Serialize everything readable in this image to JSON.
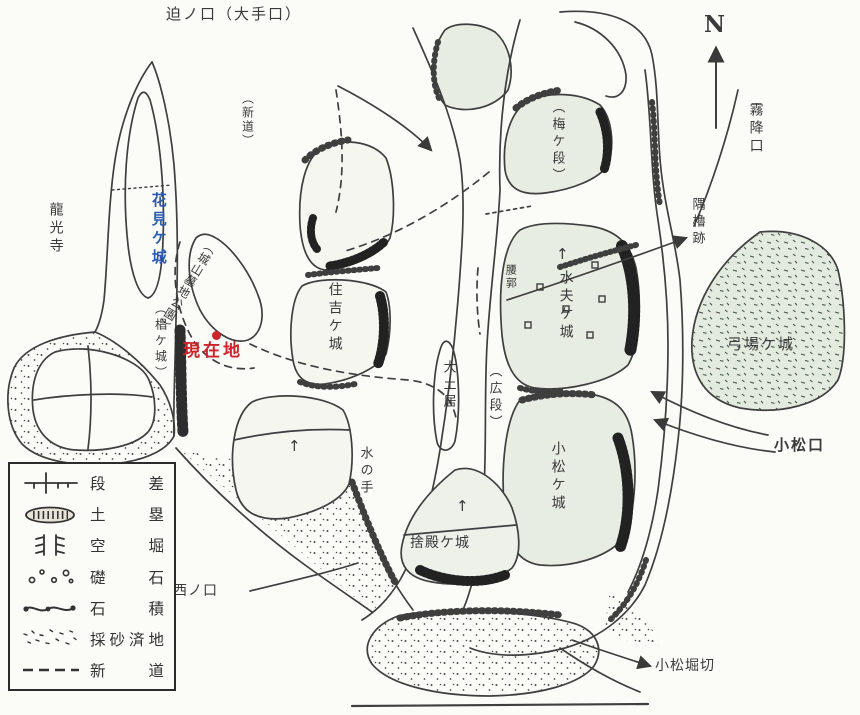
{
  "colors": {
    "paper": "#fbfbf8",
    "ink": "#3a3a3a",
    "plateau_green": "#e8ede3",
    "pale_plateau": "#f6f6f1",
    "accent_blue": "#2b5cad",
    "accent_red": "#c9252a"
  },
  "map": {
    "labels": {
      "sako_guchi": {
        "text": "迫ノ口（大手口）"
      },
      "shindo": {
        "text": "（新道）"
      },
      "north": {
        "text": "N"
      },
      "kirifuri_guchi": {
        "text": "霧降口"
      },
      "umegadan": {
        "text": "（梅ケ段）"
      },
      "sumiyagura_ato": {
        "text": "隅櫓跡"
      },
      "ryukoji": {
        "text": "龍光寺"
      },
      "hanamigajo": {
        "text": "花見ケ城"
      },
      "sugigajo": {
        "text": "（椙ケ城）"
      },
      "bochi_koen": {
        "text": "（城山墓地公園）"
      },
      "genzaichi": {
        "text": "現在地"
      },
      "sumiyoshigajo": {
        "text": "住吉ケ城"
      },
      "koshikuruwa": {
        "text": "腰郭"
      },
      "suifugajo": {
        "text": "水夫ケ城"
      },
      "odoi": {
        "text": "大土居"
      },
      "hirodan": {
        "text": "（広段）"
      },
      "mizunote": {
        "text": "水の手"
      },
      "yubagajo": {
        "text": "弓場ケ城"
      },
      "komatsu_guchi": {
        "text": "小松口"
      },
      "komatsugajo": {
        "text": "小松ケ城"
      },
      "sutedonogajo": {
        "text": "捨殿ケ城"
      },
      "nishi_guchi": {
        "text": "西ノ口"
      },
      "komatsu_horikiri": {
        "text": "小松堀切"
      },
      "arrow_up": {
        "text": "↑"
      }
    }
  },
  "legend": {
    "rows": [
      {
        "symbol": "step-icon",
        "label": "段差"
      },
      {
        "symbol": "earthwork-icon",
        "label": "土塁"
      },
      {
        "symbol": "dry-moat-icon",
        "label": "空堀"
      },
      {
        "symbol": "foundation-stone-icon",
        "label": "礎石"
      },
      {
        "symbol": "stone-masonry-icon",
        "label": "石積"
      },
      {
        "symbol": "quarried-sand-icon",
        "label": "採砂済地"
      },
      {
        "symbol": "new-road-icon",
        "label": "新道"
      }
    ]
  }
}
